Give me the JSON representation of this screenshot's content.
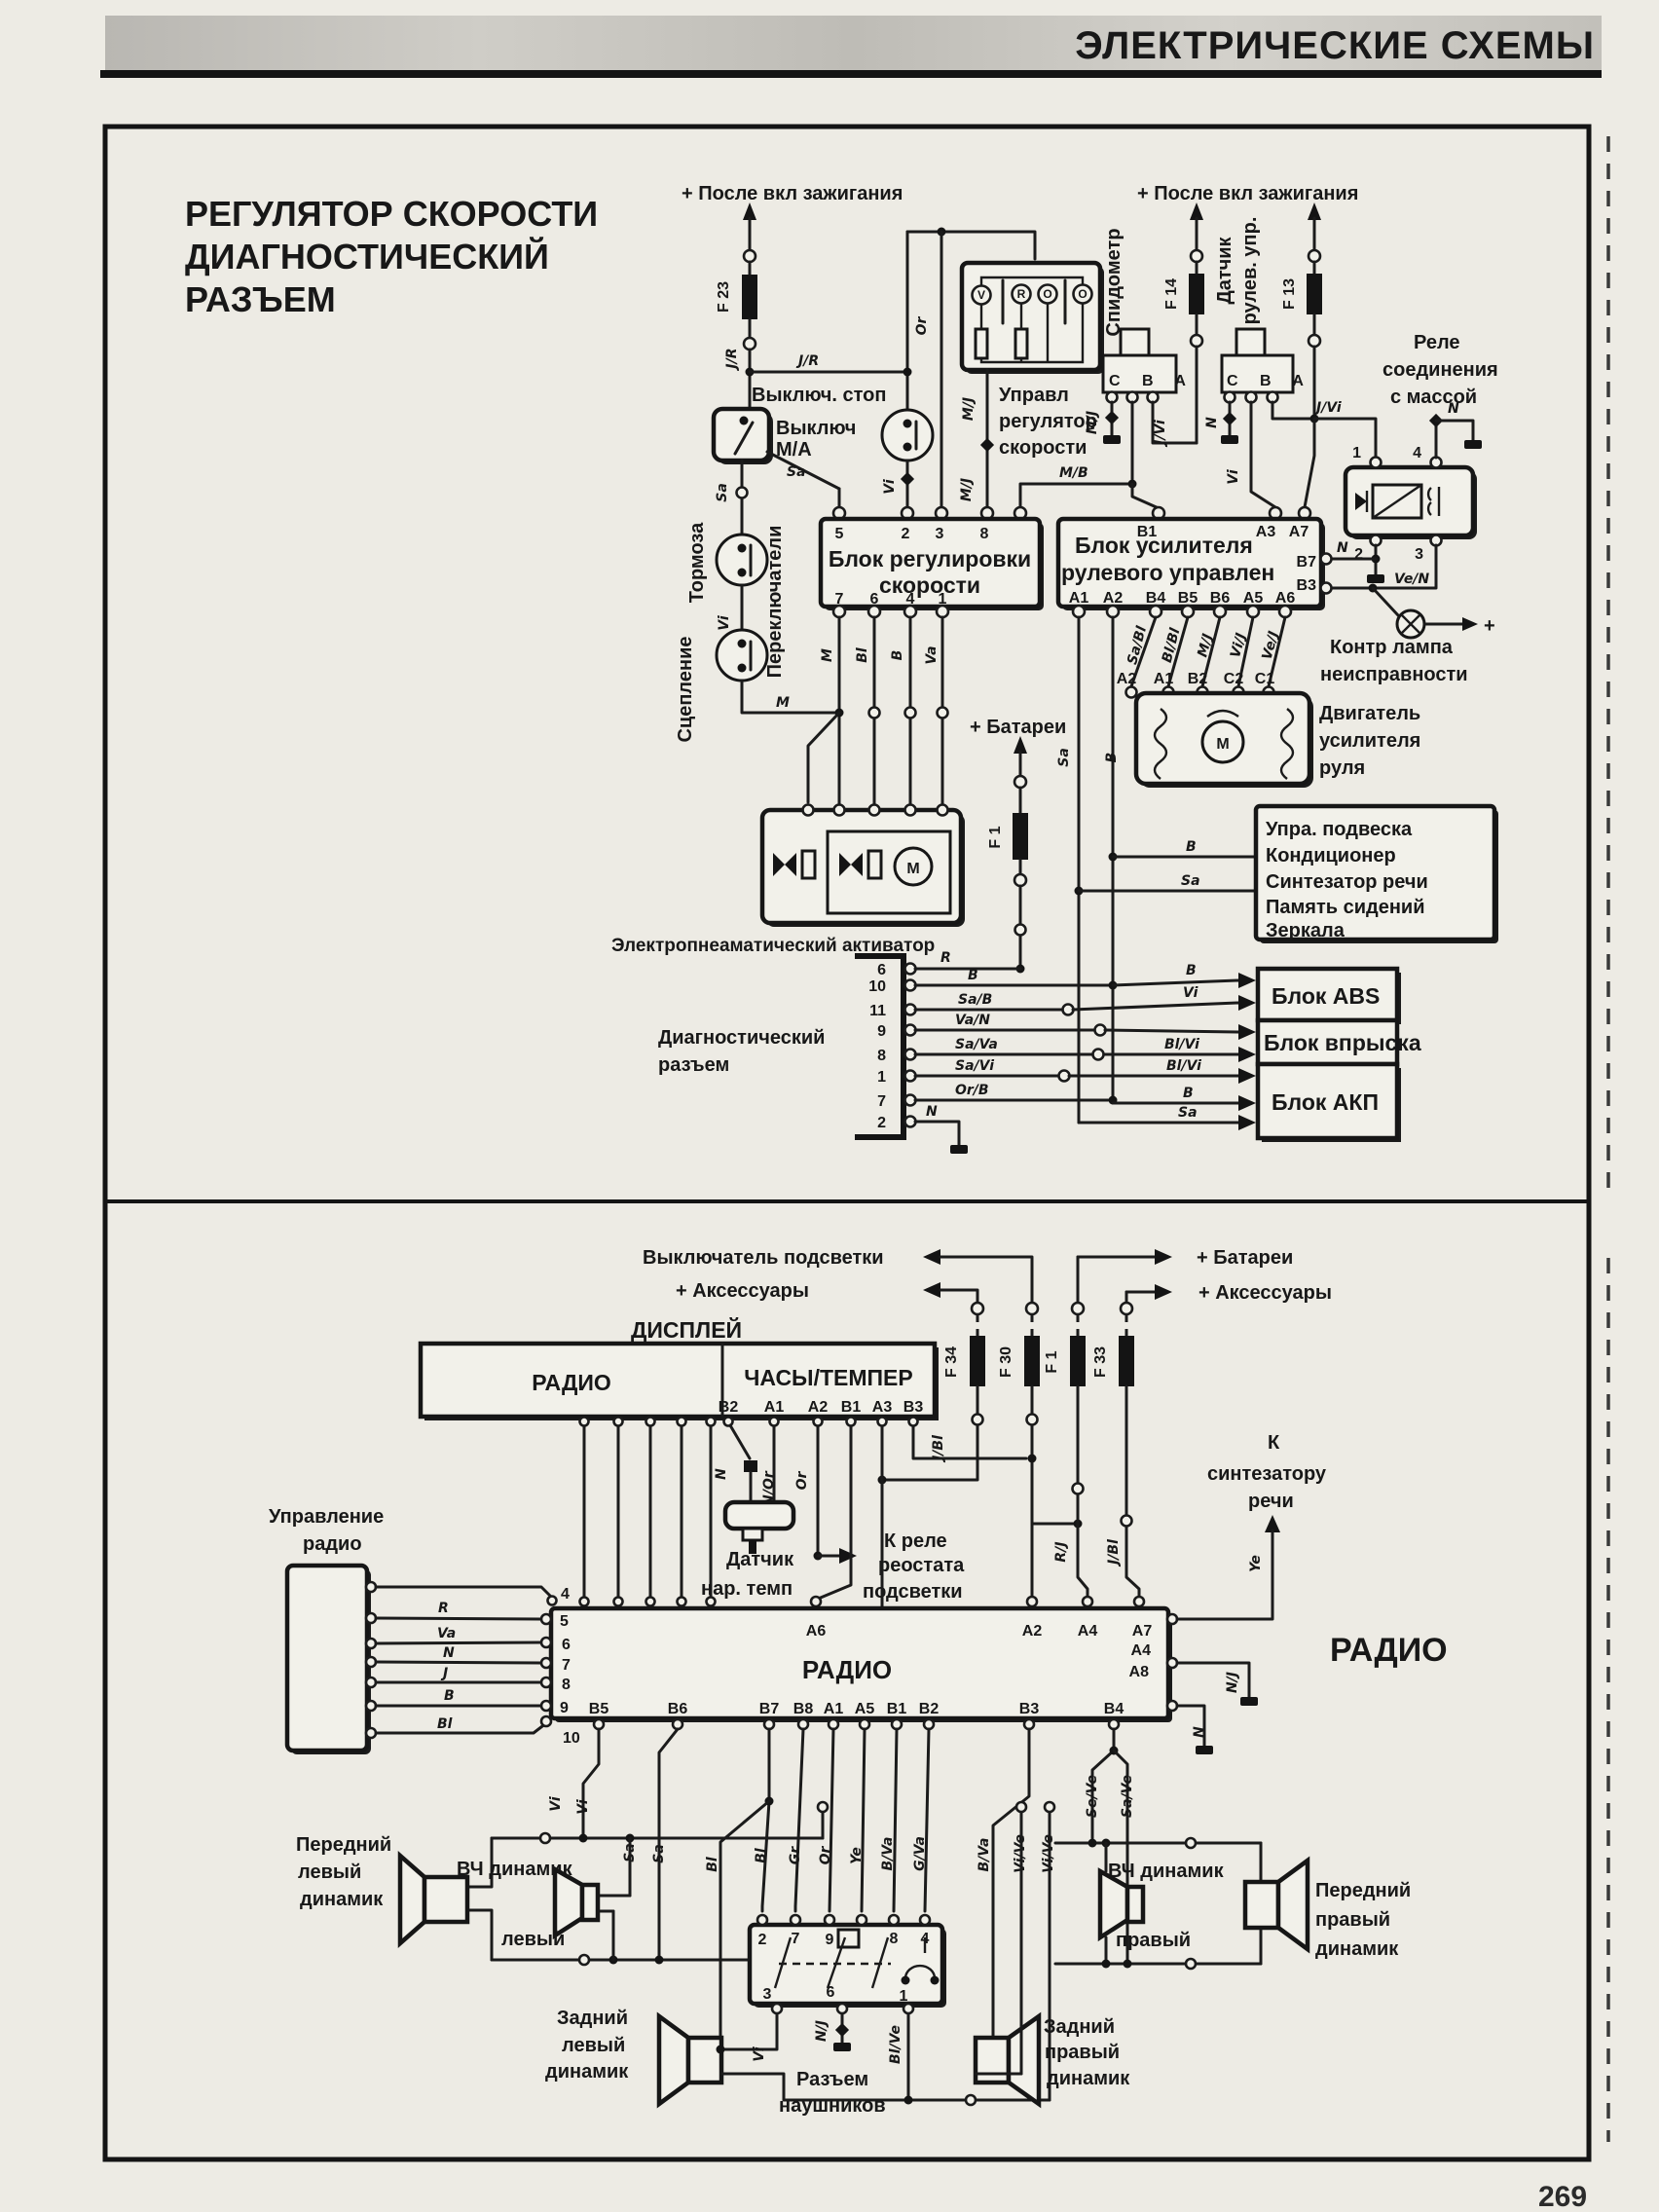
{
  "page": {
    "header": "ЭЛЕКТРИЧЕСКИЕ СХЕМЫ",
    "page_number": "269"
  },
  "d1": {
    "title": [
      "РЕГУЛЯТОР СКОРОСТИ",
      "ДИАГНОСТИЧЕСКИЙ",
      "РАЗЪЕМ"
    ],
    "ign_left": "+ После вкл  зажигания",
    "ign_right": "+ После вкл  зажигания",
    "f23": "F 23",
    "f14": "F 14",
    "f13": "F 13",
    "f1": "F 1",
    "stop_switch": "Выключ. стоп",
    "ma_switch": [
      "Выключ",
      "М/А"
    ],
    "brakes": "Тормоза",
    "clutch": "Сцепление",
    "switches": "Переключатели",
    "cruise": [
      "Управл",
      "регулятор",
      "скорости"
    ],
    "cruise_btns": [
      "V",
      "R",
      "O",
      "O"
    ],
    "speedometer": "Спидометр",
    "sensor": [
      "Датчик",
      "рулев. упр."
    ],
    "cba_left": "C  B  A",
    "cba_right": "C  B  A",
    "relay_title": [
      "Реле",
      "соединения",
      "с массой"
    ],
    "relay_pins": [
      "1",
      "4",
      "2",
      "3"
    ],
    "reg_block": [
      "Блок регулировки",
      "скорости"
    ],
    "reg_pins_top": [
      "5",
      "2",
      "3",
      "8"
    ],
    "reg_pins_bot": [
      "7",
      "6",
      "4",
      "1"
    ],
    "steer_block": [
      "Блок усилителя",
      "рулевого управлен"
    ],
    "steer_pins_top": [
      "B1",
      "A3",
      "A7"
    ],
    "steer_pins_right": [
      "B7",
      "B3"
    ],
    "steer_pins_bot": [
      "A1",
      "A2",
      "B4",
      "B5",
      "B6",
      "A5",
      "A6"
    ],
    "lamp": [
      "Контр  лампа",
      "неисправности"
    ],
    "plus": "+",
    "motor_title": [
      "Двигатель",
      "усилителя",
      "руля"
    ],
    "motor_m": "М",
    "motor_pins": [
      "A2",
      "A1",
      "B2",
      "C2",
      "C1"
    ],
    "battery": "+ Батареи",
    "activator": "Электропнеаматический активатор",
    "diag_label": [
      "Диагностический",
      "разъем"
    ],
    "diag_pins": [
      "6",
      "10",
      "11",
      "9",
      "8",
      "1",
      "7",
      "2"
    ],
    "aux_box": [
      "Упра. подвеска",
      "Кондиционер",
      "Синтезатор речи",
      "Память сидений",
      "Зеркала"
    ],
    "abs": "Блок ABS",
    "inj": "Блок впрыска",
    "akp": "Блок АКП",
    "w": {
      "jr1": "J/R",
      "jr2": "J/R",
      "sa1": "Sa",
      "sa2": "Sa",
      "vi1": "Vi",
      "m1": "M",
      "or1": "Or",
      "vi2": "Vi",
      "mj1": "M/J",
      "mj2": "M/J",
      "mb": "М/В",
      "mj3": "M/J",
      "jvi1": "J/Vi",
      "n1": "N",
      "vi3": "Vi",
      "jvi2": "J/Vi",
      "n2": "N",
      "n3": "N",
      "ven": "Ve/N",
      "m2": "M",
      "bl": "Bl",
      "b1": "B",
      "va": "Va",
      "sabl": "Sa/Bl",
      "blbl": "Bl/Bl",
      "mj4": "M/J",
      "vij": "Vi/J",
      "vej": "Ve/J",
      "sa3": "Sa",
      "b2": "B",
      "b3": "B",
      "sa4": "Sa",
      "r": "R",
      "b4": "B",
      "sab": "Sa/B",
      "van": "Va/N",
      "sava": "Sa/Va",
      "savi": "Sa/Vi",
      "orb": "Or/B",
      "n4": "N",
      "b5": "B",
      "vi4": "Vi",
      "blvi1": "Bl/Vi",
      "blvi2": "Bl/Vi",
      "b6": "B",
      "sa5": "Sa"
    }
  },
  "d2": {
    "backlight": "Выключатель подсветки",
    "acc_left": "+ Аксессуары",
    "battery": "+ Батареи",
    "acc_right": "+ Аксессуары",
    "f34": "F 34",
    "f30": "F 30",
    "f1": "F 1",
    "f33": "F 33",
    "display": "ДИСПЛЕЙ",
    "disp_radio": "РАДИО",
    "disp_clock": "ЧАСЫ/ТЕМПЕР",
    "disp_pins": [
      "B2",
      "A1",
      "A2",
      "B1",
      "A3",
      "B3"
    ],
    "temp_sensor": [
      "Датчик",
      "нар. темп"
    ],
    "rheostat": [
      "К реле",
      "реостата",
      "подсветки"
    ],
    "synth": [
      "К",
      "синтезатору",
      "речи"
    ],
    "ctrl": [
      "Управление",
      "радио"
    ],
    "radio": "РАДИО",
    "radio_big": "РАДИО",
    "pins_left": [
      "4",
      "5",
      "6",
      "7",
      "8",
      "9",
      "10"
    ],
    "pins_top": [
      "A6",
      "A2",
      "A4",
      "A7"
    ],
    "pins_right": [
      "A4",
      "A8"
    ],
    "pins_bot": [
      "B5",
      "B6",
      "B7",
      "B8",
      "A1",
      "A5",
      "B1",
      "B2",
      "B3",
      "B4"
    ],
    "hp_top": [
      "2",
      "7",
      "9",
      "5",
      "8",
      "4"
    ],
    "hp_bot": [
      "3",
      "6",
      "1"
    ],
    "hp_label": [
      "Разъем",
      "наушников"
    ],
    "sp_fl": [
      "Передний",
      "левый",
      "динамик"
    ],
    "sp_twl": [
      "ВЧ динамик",
      "левый"
    ],
    "sp_rl": [
      "Задний",
      "левый",
      "динамик"
    ],
    "sp_rr": [
      "Задний",
      "правый",
      "динамик"
    ],
    "sp_twr": [
      "ВЧ динамик",
      "правый"
    ],
    "sp_fr": [
      "Передний",
      "правый",
      "динамик"
    ],
    "w": {
      "ctrl": [
        "R",
        "Va",
        "N",
        "J",
        "B",
        "Bl"
      ],
      "n1": "N",
      "nor": "N/Or",
      "or1": "Or",
      "jbl1": "J/Bl",
      "rj": "R/J",
      "jbl2": "J/Bl",
      "ye1": "Ye",
      "vi1": "Vi",
      "vi2": "Vi",
      "sa1": "Sa",
      "sa2": "Sa",
      "bl1": "Bl",
      "bl2": "Bl",
      "gr": "Gr",
      "or2": "Or",
      "ye2": "Ye",
      "bva1": "B/Va",
      "gva": "G/Va",
      "bva2": "B/Va",
      "vive1": "Vi/Ve",
      "vive2": "Vi/Ve",
      "seve": "Se/Ve",
      "save": "Sa/Ve",
      "nj1": "N/J",
      "n2": "N",
      "vi3": "Vi",
      "nj2": "N/J",
      "blve": "Bl/Ve"
    }
  }
}
